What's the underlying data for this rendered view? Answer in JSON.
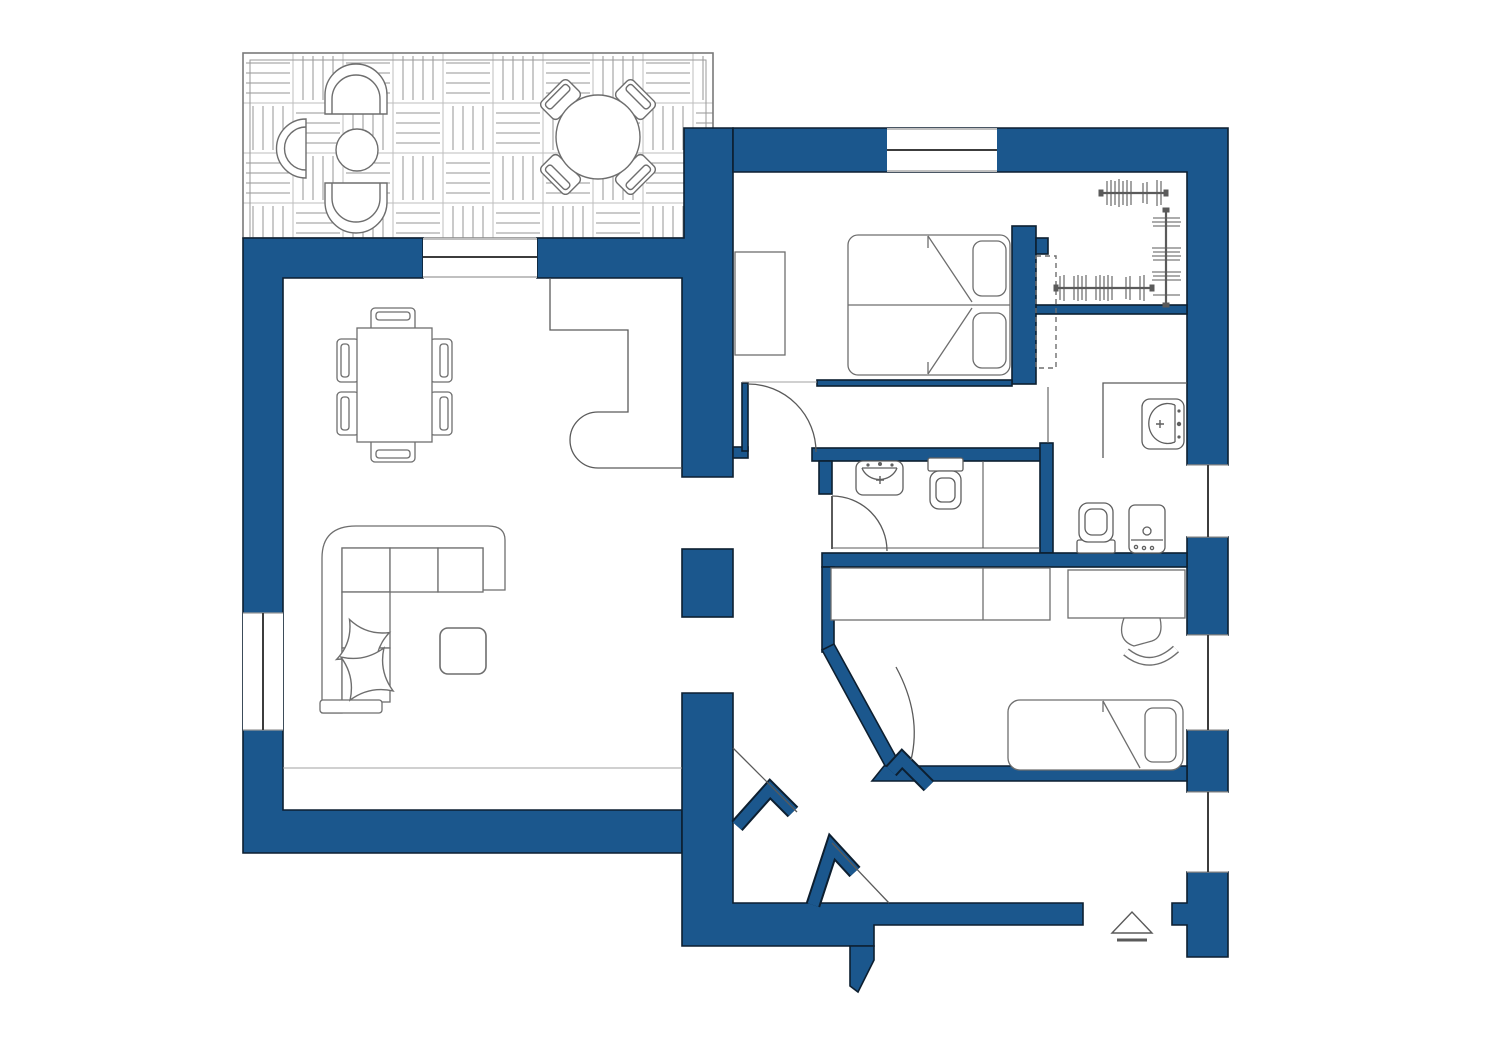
{
  "drawing": {
    "kind": "apartment-floor-plan",
    "background": "#ffffff"
  },
  "colors": {
    "wall_fill": "#1B578D",
    "wall_edge": "#0D1F30",
    "furniture_line": "#6e6e6e",
    "fixture_line": "#5f5f5f",
    "thin_line": "#5a5a5a",
    "light_line": "#a2a2a2",
    "paving_line": "#949494",
    "paving_grid": "#bdbdbd",
    "white": "#ffffff"
  },
  "rooms": [
    {
      "name": "terrace"
    },
    {
      "name": "living-room"
    },
    {
      "name": "master-bedroom"
    },
    {
      "name": "walk-in-closet"
    },
    {
      "name": "bathroom"
    },
    {
      "name": "second-bathroom"
    },
    {
      "name": "kids-bedroom"
    },
    {
      "name": "entry-hall"
    }
  ],
  "furniture": {
    "terrace": [
      "lounge-chair",
      "arch-armchair",
      "arch-armchair",
      "side-table",
      "round-dining-table",
      "terrace-chair",
      "terrace-chair",
      "terrace-chair",
      "terrace-chair"
    ],
    "living_room": [
      "dining-table",
      "dining-chair x6",
      "corner-sofa",
      "pillow x2",
      "coffee-table"
    ],
    "master_bedroom": [
      "double-bed",
      "pillow x2",
      "dresser",
      "clothes-rack x3"
    ],
    "bathroom": [
      "washbasin",
      "toilet"
    ],
    "second_bathroom": [
      "washbasin",
      "toilet",
      "washing-machine"
    ],
    "kids_bedroom": [
      "desk",
      "wardrobe-counter",
      "desk-chair",
      "single-bed"
    ]
  },
  "symbols": {
    "entrance_marker": "triangle-with-step"
  }
}
